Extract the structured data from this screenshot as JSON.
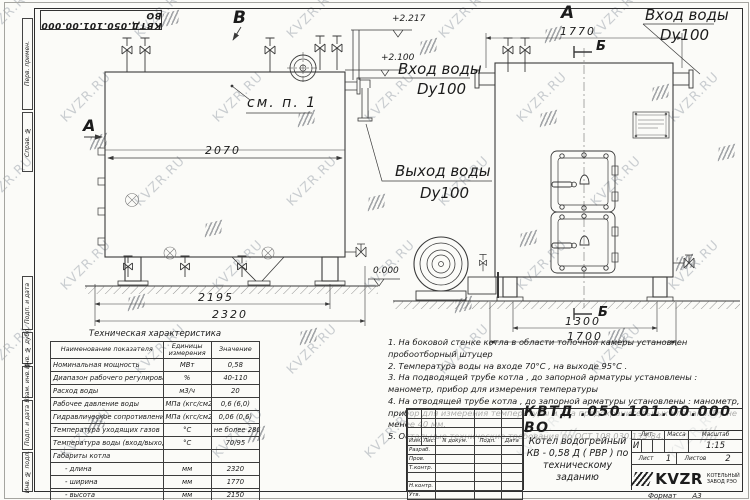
{
  "watermark": {
    "text": "KVZR.RU"
  },
  "stamp_top": "КВТД.050.101.00.000  ВО",
  "side_strip": [
    "Перв. примен.",
    "Справ. №",
    "Подп. и дата",
    "Инв. № дубл.",
    "Взам. инв. №",
    "Подп. и дата",
    "Инв. № подл."
  ],
  "views": {
    "view_b": "В",
    "view_a_left": "А",
    "view_a_right": "А",
    "section_b_top": "Б",
    "section_b_bottom": "Б",
    "see_note": "см. п. 1",
    "inlet_left": {
      "line1": "Вход воды",
      "line2": "Dy100"
    },
    "outlet": {
      "line1": "Выход воды",
      "line2": "Dy100"
    },
    "inlet_right": {
      "line1": "Вход воды",
      "line2": "Dy100"
    },
    "elevations": {
      "top": "+2.217",
      "mid": "+2.100",
      "zero": "0.000"
    },
    "dims": {
      "d2070": "2070",
      "d2195": "2195",
      "d2320": "2320",
      "d1770": "1770",
      "d1300": "1300",
      "d1700": "1700"
    }
  },
  "tech_table": {
    "title": "Техническая характеристика",
    "columns": [
      "Наименование показателя",
      "Единицы измерения",
      "Значение"
    ],
    "rows": [
      [
        "Номинальная мощность",
        "МВт",
        "0,58"
      ],
      [
        "Диапазон рабочего регулирования",
        "%",
        "40-110"
      ],
      [
        "Расход воды",
        "м3/ч",
        "20"
      ],
      [
        "Рабочее давление воды",
        "МПа (кгс/см2)",
        "0,6 (6,0)"
      ],
      [
        "Гидравлическое сопротивление котла",
        "МПа (кгс/см2)",
        "0,06 (0,6)"
      ],
      [
        "Температура уходящих газов",
        "°С",
        "не более 280"
      ],
      [
        "Температура воды (вход/выход)",
        "°С",
        "70/95"
      ],
      [
        "Габариты котла",
        "",
        ""
      ],
      [
        "- длина",
        "мм",
        "2320"
      ],
      [
        "- ширина",
        "мм",
        "1770"
      ],
      [
        "- высота",
        "мм",
        "2150"
      ]
    ]
  },
  "notes": [
    "1.  На боковой стенке котла в области топочной камеры установлен пробоотборный штуцер",
    "2.  Температура воды на входе  70°С ,  на выходе  95°С .",
    "3.  На подводящей трубе котла , до запорной арматуры установлены :  манометр,  прибор для измерения температуры",
    "4.  На отводящей трубе котла , до запорной арматуры установлены :  манометр,  прибор для измерения температуры и два предохранительных клапана.  Dу не менее  40 мм.",
    "5.  Остальные технические требования по ОСТ  108.030.133-84."
  ],
  "title_block": {
    "doc_number": "КВТД .050.101.00.000   ВО",
    "description_lines": [
      "Котел водогрейный",
      "КВ - 0,58  Д  ( РВР )  по",
      "техническому заданию"
    ],
    "rev_columns": [
      "Изм.",
      "Лист",
      "N докум.",
      "Подп.",
      "Дата"
    ],
    "roles": [
      "Разраб.",
      "Пров.",
      "Т.контр.",
      "",
      "Н.контр.",
      "Утв."
    ],
    "lit_label": "Лит.",
    "lit_value": "И",
    "mass_label": "Масса",
    "scale_label": "Масштаб",
    "scale_value": "1:15",
    "sheet_label": "Лист",
    "sheet_value": "1",
    "sheets_label": "Листов",
    "sheets_value": "2",
    "logo_text": "KVZR",
    "company_lines": [
      "КОТЕЛЬНЫЙ",
      "ЗАВОД РЭО"
    ],
    "format_label": "Формат",
    "format_value": "А3"
  }
}
